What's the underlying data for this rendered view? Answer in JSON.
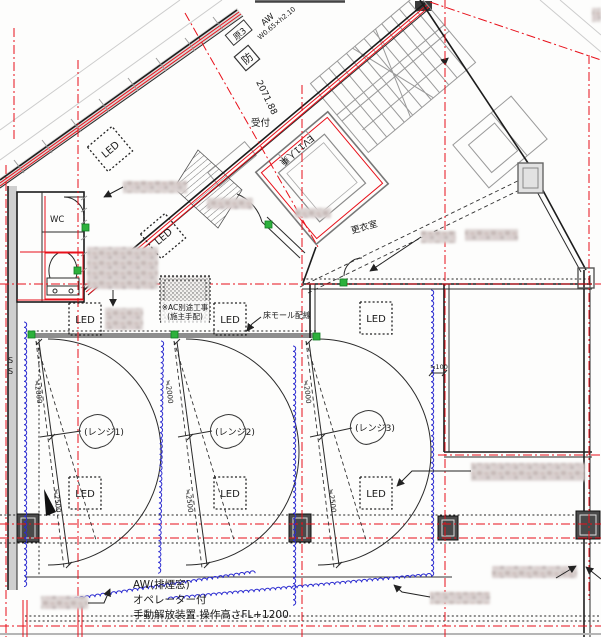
{
  "canvas": {
    "width": 601,
    "height": 637
  },
  "colors": {
    "axis_red": "#e8101a",
    "wiring_blue": "#2b2bd0",
    "marker_green": "#2db13c",
    "wall_black": "#1c1c1c",
    "hatch_gray": "#9a9a9a"
  },
  "rooms": {
    "reception": "受付",
    "wc": "WC",
    "elevator": "EV11人乗",
    "changing_room": "更衣室"
  },
  "ranges": {
    "range1": "(レンジ1)",
    "range2": "(レンジ2)",
    "range3": "(レンジ3)"
  },
  "fixtures": {
    "led": "LED",
    "coil_end": "S"
  },
  "notes": {
    "floor_mold": "床モール配線",
    "ac_line1": "※AC別途工事",
    "ac_line2": "(施主手配)",
    "smoke1": "AW(排煙窓)",
    "smoke2": "オペレーター付",
    "smoke3": "手動解放装置 操作高さFL+1200"
  },
  "tags": {
    "window_no": "原3",
    "window_type": "AW",
    "window_size": "W0.65×h2.10",
    "fire": "防",
    "diag_dim": "2071.88"
  },
  "dims": {
    "d2000": "≒2000",
    "d2500": "≒2500",
    "d100": "≒100"
  }
}
